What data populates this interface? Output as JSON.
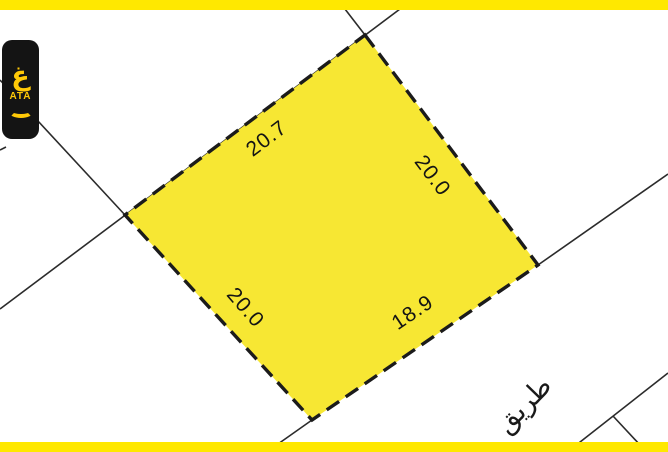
{
  "map": {
    "plot": {
      "fill_color": "#F7E733",
      "border_color": "#1b1b1b",
      "edge_labels": {
        "top_left": "20.7",
        "top_right": "20.0",
        "bottom_left": "20.0",
        "bottom_right": "18.9"
      }
    },
    "road_label": "طريق",
    "bars_color": "#FFE800",
    "boundary_line_color": "#2b2b2b"
  },
  "logo": {
    "glyph": "غ",
    "wordmark": "ATA",
    "bg_color": "#141414",
    "fg_color": "#FFC907"
  }
}
